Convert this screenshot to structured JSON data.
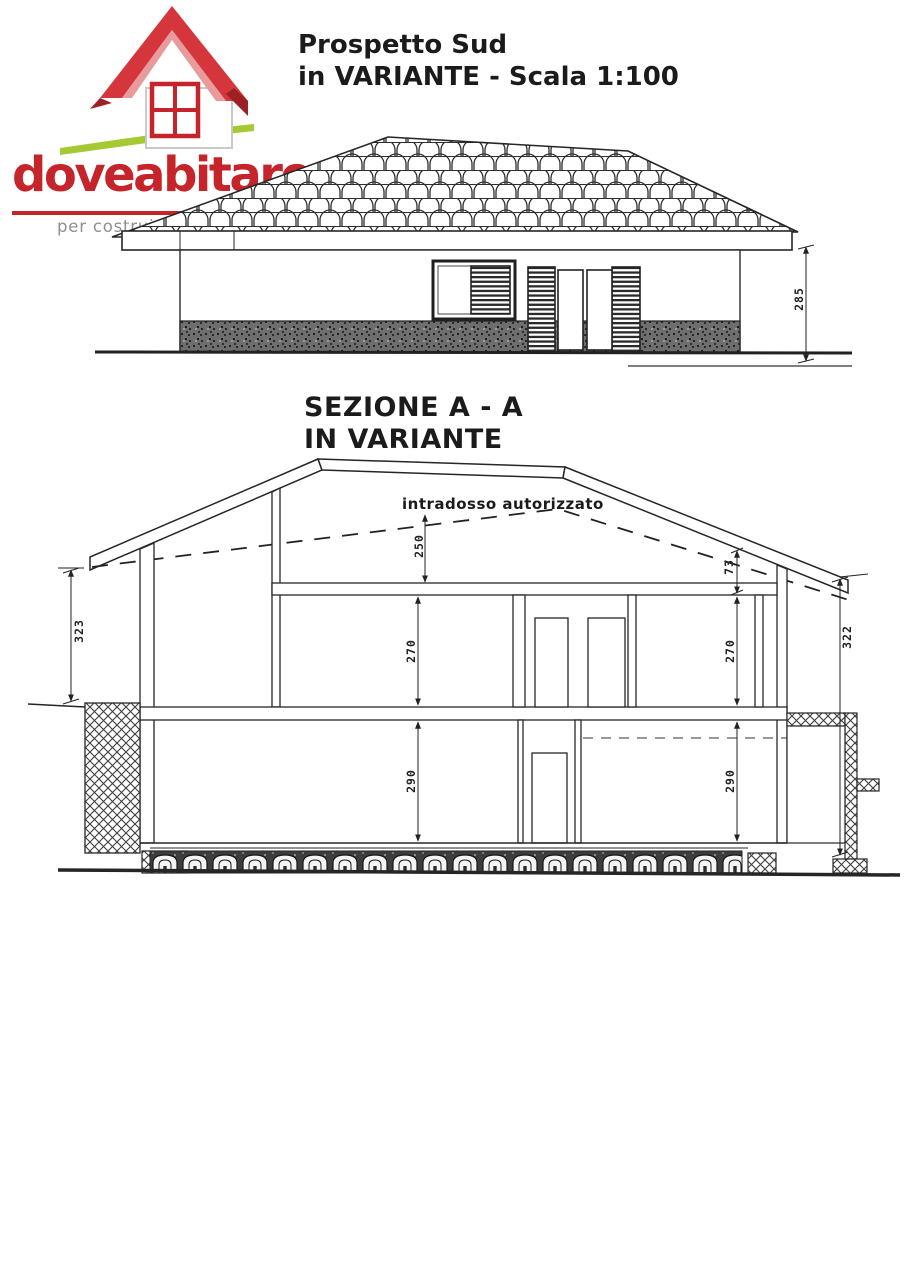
{
  "logo": {
    "brand": "doveabitare",
    "tagline": "per costruire il tuo futuro",
    "colors": {
      "red": "#c5242b",
      "roof_red": "#d4363c",
      "dark_red": "#9c2125",
      "pink": "#e79b9b",
      "green": "#a6c832",
      "gray": "#8f8f8f",
      "white": "#ffffff"
    }
  },
  "elevation": {
    "title_line1": "Prospetto Sud",
    "title_line2": "in VARIANTE - Scala 1:100",
    "dims": {
      "facade_height": "285"
    }
  },
  "section": {
    "title_line1": "SEZIONE A - A",
    "title_line2": "IN VARIANTE",
    "annotation": "intradosso autorizzato",
    "dims": {
      "attic_height": "250",
      "eave_offset": "73",
      "left_overall": "323",
      "right_overall": "322",
      "first_floor_center": "270",
      "first_floor_right": "270",
      "ground_floor_center": "290",
      "ground_floor_right": "290"
    }
  }
}
